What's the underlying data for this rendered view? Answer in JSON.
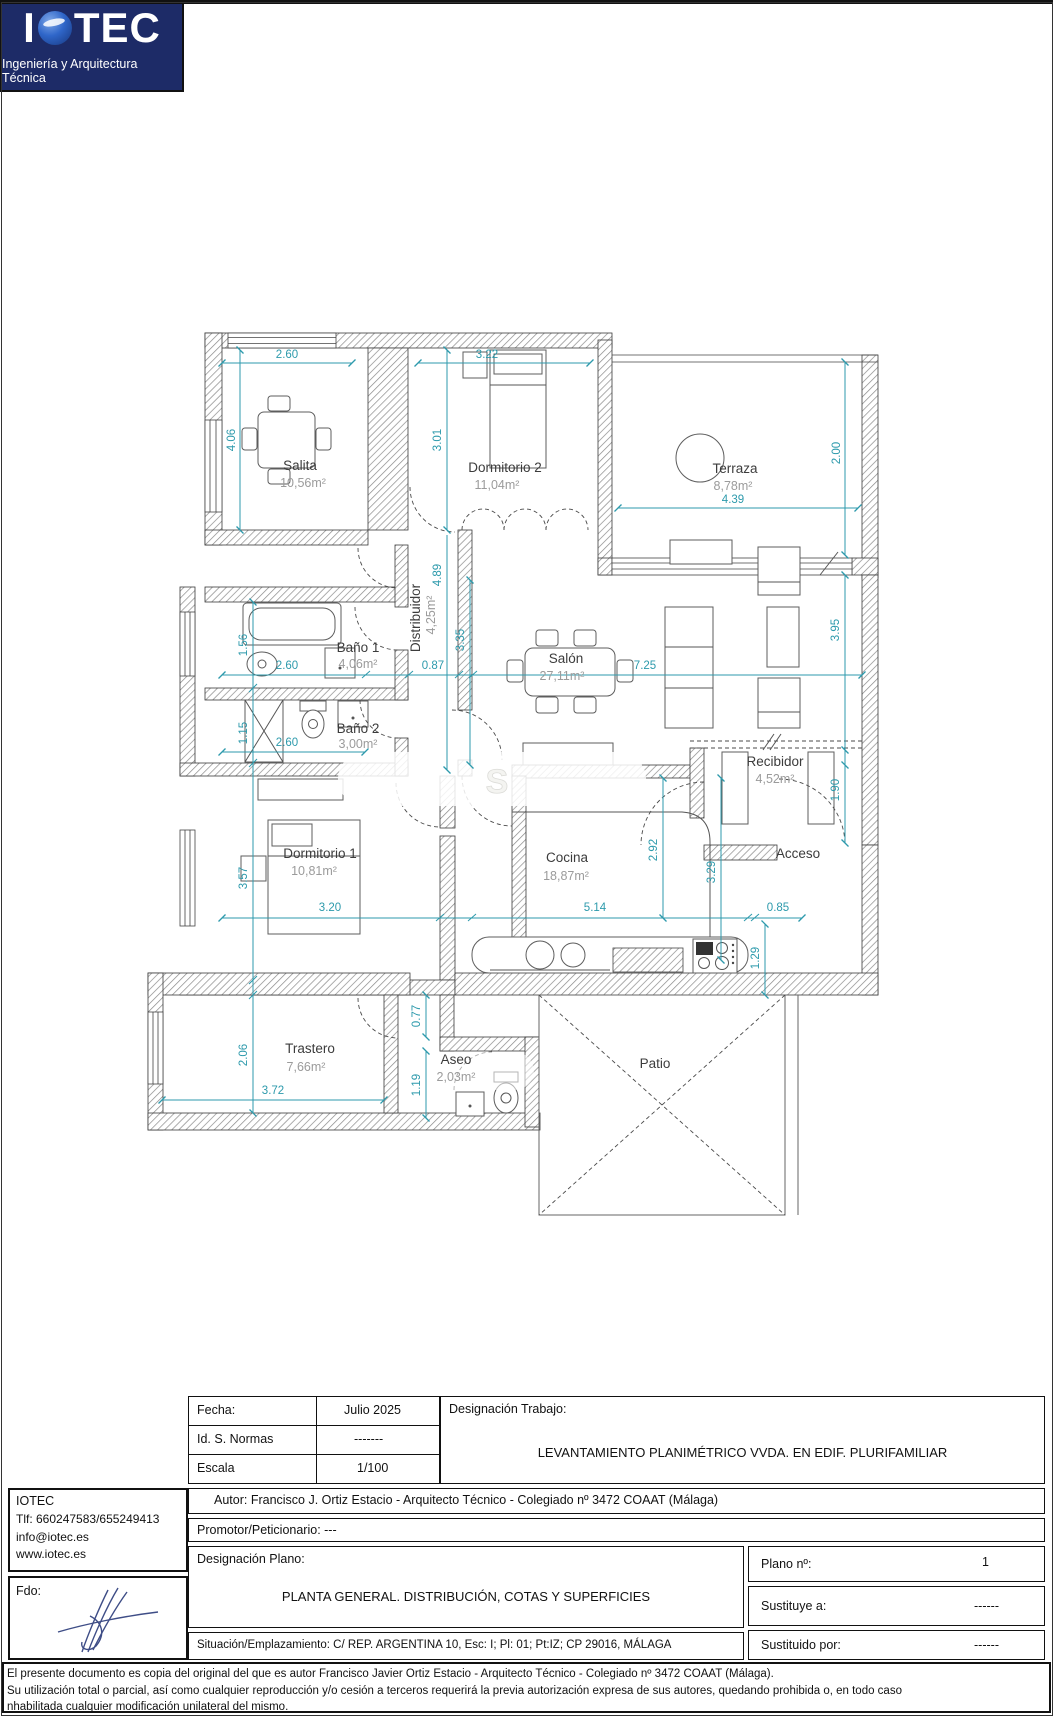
{
  "plan": {
    "rooms": {
      "salita": {
        "name": "Salita",
        "area": "10,56m²"
      },
      "dormitorio2": {
        "name": "Dormitorio 2",
        "area": "11,04m²"
      },
      "terraza": {
        "name": "Terraza",
        "area": "8,78m²"
      },
      "banyo1": {
        "name": "Baño 1",
        "area": "4,06m²"
      },
      "distribuidor": {
        "name": "Distribuidor",
        "area": "4,25m²"
      },
      "salon": {
        "name": "Salón",
        "area": "27,11m²"
      },
      "banyo2": {
        "name": "Baño 2",
        "area": "3,00m²"
      },
      "dormitorio1": {
        "name": "Dormitorio 1",
        "area": "10,81m²"
      },
      "cocina": {
        "name": "Cocina",
        "area": "18,87m²"
      },
      "recibidor": {
        "name": "Recibidor",
        "area": "4,52m²"
      },
      "trastero": {
        "name": "Trastero",
        "area": "7,66m²"
      },
      "aseo": {
        "name": "Aseo",
        "area": "2,03m²"
      },
      "patio": {
        "name": "Patio"
      },
      "acceso": {
        "name": "Acceso"
      }
    },
    "dims": {
      "salita_w": "2.60",
      "salita_h": "4.06",
      "dorm2_w": "3.22",
      "dorm2_h": "3.01",
      "terraza_w": "4.39",
      "terraza_h": "2.00",
      "banyo1_w": "2.60",
      "banyo1_h": "1.56",
      "pasillo_w": "0.87",
      "distribuidor_h": "4.89",
      "salon_w": "7.25",
      "salon_h": "3.35",
      "salon_d": "3.95",
      "banyo2_w": "2.60",
      "banyo2_h": "1.15",
      "dorm1_w": "3.20",
      "dorm1_h": "3.57",
      "cocina_w": "5.14",
      "cocina_h": "2.92",
      "cocina_d": "3.29",
      "recibidor_w": "0.85",
      "recibidor_h": "1.90",
      "paso_cocina": "1.29",
      "trastero_w": "3.72",
      "trastero_h": "2.06",
      "paso_bajo": "0.77",
      "aseo_h": "1.19"
    },
    "watermark": "S"
  },
  "titleblock": {
    "logo": {
      "brand_i": "I",
      "brand_tec": "TEC",
      "tagline": "Ingeniería y Arquitectura Técnica"
    },
    "fields": {
      "fecha_label": "Fecha:",
      "fecha_value": "Julio 2025",
      "normas_label": "Id. S. Normas",
      "normas_value": "-------",
      "escala_label": "Escala",
      "escala_value": "1/100",
      "trabajo_label": "Designación Trabajo:",
      "trabajo_value": "LEVANTAMIENTO PLANIMÉTRICO VVDA. EN EDIF. PLURIFAMILIAR",
      "autor": "Autor: Francisco J. Ortiz Estacio - Arquitecto Técnico  - Colegiado nº 3472 COAAT (Málaga)",
      "promotor": "Promotor/Peticionario: ---",
      "plano_label": "Designación Plano:",
      "plano_value": "PLANTA GENERAL. DISTRIBUCIÓN, COTAS Y SUPERFICIES",
      "situacion": "Situación/Emplazamiento: C/ REP. ARGENTINA 10, Esc: I; Pl: 01; Pt:IZ; CP 29016, MÁLAGA",
      "plano_num_label": "Plano nº:",
      "plano_num_value": "1",
      "sustituye_label": "Sustituye a:",
      "sustituye_value": "------",
      "sustituido_label": "Sustituido por:",
      "sustituido_value": "------",
      "fdo": "Fdo:"
    },
    "contact": {
      "name": "IOTEC",
      "tlf": "Tlf: 660247583/655249413",
      "email": "info@iotec.es",
      "web": "www.iotec.es"
    },
    "disclaimer": {
      "line1": "El presente documento es copia del original del que es autor  Francisco Javier Ortiz Estacio - Arquitecto Técnico - Colegiado nº 3472 COAAT (Málaga).",
      "line2": "Su utilización total o parcial, así como cualquier reproducción y/o cesión a terceros requerirá la previa autorización expresa de sus autores, quedando prohibida o, en todo caso",
      "line3": "nhabilitada cualquier modificación unilateral del mismo."
    }
  }
}
